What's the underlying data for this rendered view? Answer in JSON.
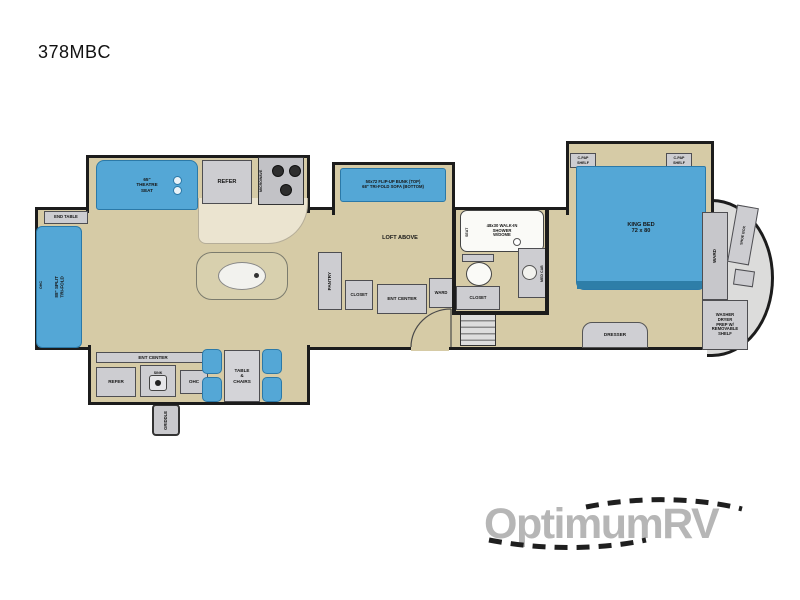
{
  "title": "378MBC",
  "watermark": "OptimumRV",
  "colors": {
    "floor": "#d6cba6",
    "furniture_blue": "#54a7d6",
    "wall": "#1c1c1c",
    "cabinet_gray": "#cdcdd1",
    "watermark_gray": "#b6b6b6"
  },
  "plan": {
    "rear": {
      "end_table": "END TABLE",
      "ohc": "OHC",
      "sofa": "88\" SPLIT\nTRI-FOLD"
    },
    "living": {
      "theatre": "65\"\nTHEATRE\nSEAT",
      "refer": "REFER",
      "microwave": "MICROWAVE",
      "loft": "LOFT ABOVE"
    },
    "bunk": {
      "label": "50x72 FLIP-UP BUNK (TOP)\n68\" TRI-FOLD SOFA (BOTTOM)"
    },
    "hall": {
      "pantry": "PANTRY",
      "closet": "CLOSET",
      "ent_center": "ENT CENTER",
      "ward": "WARD"
    },
    "bath": {
      "shower": "48x30 WALK-IN\nSHOWER\nW/DOME",
      "seat": "SEAT",
      "closet": "CLOSET",
      "med_cab": "MED CAB"
    },
    "bedroom": {
      "bed": "KING BED\n72 x 80",
      "cpap": "C-PAP\nSHELF",
      "dresser": "DRESSER",
      "ward": "WARD",
      "shoe_box": "SHOE BOX",
      "washer": "WASHER\nDRYER\nPREP W/\nREMOVABLE\nSHELF"
    },
    "exterior": {
      "ent_center": "ENT CENTER",
      "refer": "REFER",
      "sink": "SINK",
      "ohc": "OHC",
      "griddle": "GRIDDLE"
    },
    "dinette": {
      "label": "TABLE\n&\nCHAIRS"
    }
  }
}
